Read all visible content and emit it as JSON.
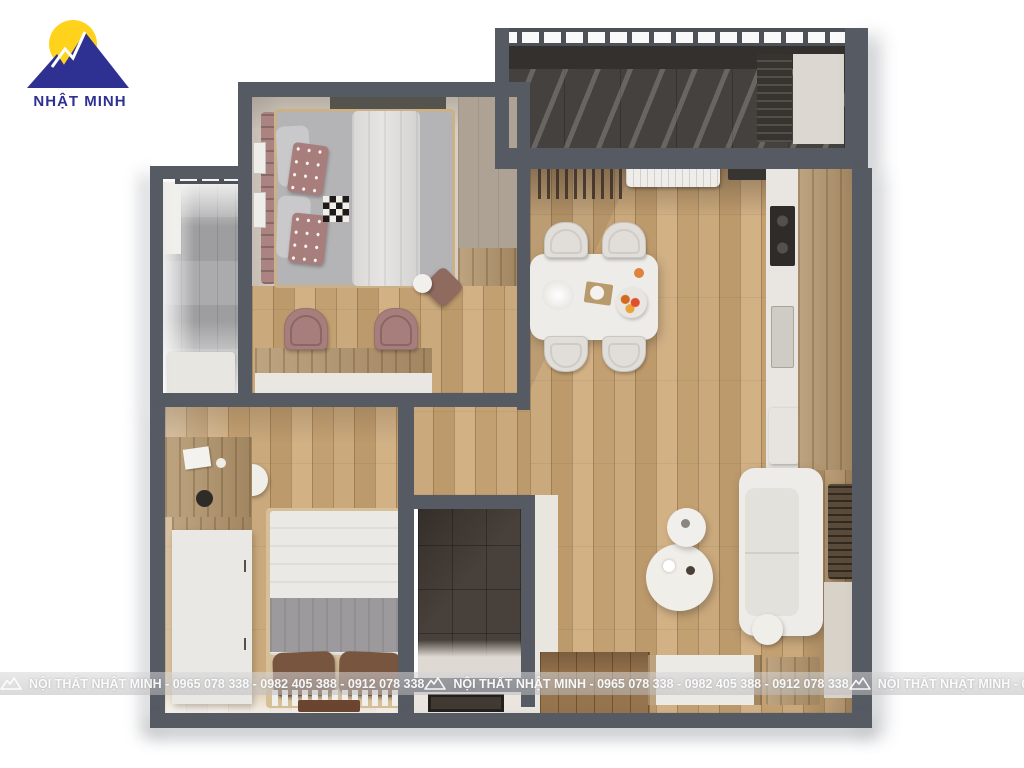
{
  "logo": {
    "brand": "NHẬT MINH",
    "icon": "mountain-sun-logo",
    "colors": {
      "mountain_blue": "#2E3192",
      "sun_yellow": "#FFD21C"
    }
  },
  "watermark": {
    "company": "NỘI THẤT NHẬT MINH",
    "phones": [
      "0965 078 338",
      "0982 405 388",
      "0912 078 338"
    ],
    "text": "NỘI THẤT NHẬT MINH - 0965 078 338 - 0982 405 388 - 0912 078 338",
    "repeat": 3,
    "icon": "mountain-icon",
    "text_color": "#FFFFFF"
  },
  "palette": {
    "wall": "#565B63",
    "wood_floor": "#C6A375",
    "grey_wood": "#A7A7A9",
    "dark_balcony_tile": "#45413E",
    "bathroom_tile": "#48403A",
    "accent_rose": "#A87E7C",
    "carpet_cream": "#D8CFC4",
    "white_furniture": "#ECEAE6"
  }
}
